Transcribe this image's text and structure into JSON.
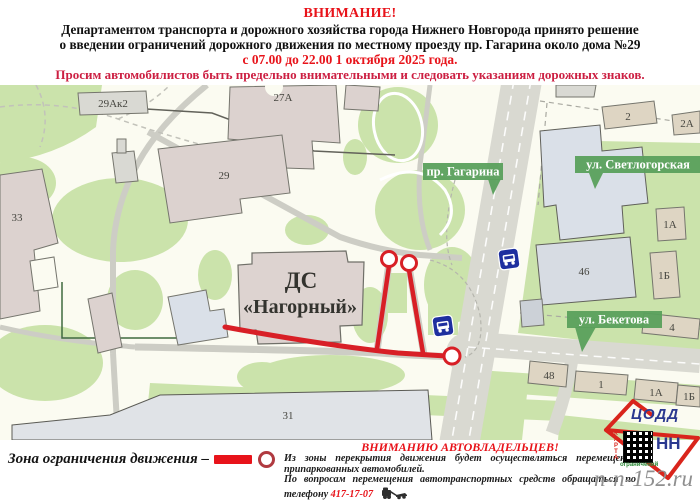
{
  "header": {
    "attention": "ВНИМАНИЕ!",
    "line1": "Департаментом транспорта и дорожного хозяйства города Нижнего Новгорода принято решение",
    "line2": "о введении ограничений дорожного движения по местному проезду пр. Гагарина около дома №29",
    "schedule": "с 07.00 до 22.00 1 октября 2025 года.",
    "plea": "Просим автомобилистов быть предельно внимательными и следовать указаниям дорожных знаков."
  },
  "map": {
    "streets": [
      {
        "name": "пр. Гагарина"
      },
      {
        "name": "ул. Светлогорская"
      },
      {
        "name": "ул. Бекетова"
      }
    ],
    "venue": {
      "line1": "ДС",
      "line2": "«Нагорный»"
    },
    "building_labels": [
      "29Ак2",
      "27А",
      "29",
      "33",
      "31",
      "2",
      "2А",
      "1А",
      "1Б",
      "46",
      "4",
      "48",
      "1",
      "1А",
      "1Б"
    ]
  },
  "legend": {
    "label": "Зона ограничения движения –"
  },
  "notice": {
    "title": "ВНИМАНИЮ АВТОВЛАДЕЛЬЦЕВ!",
    "body1": "Из зоны перекрытия движения будет осуществляться перемещение припаркованных автомобилей.",
    "body2": "По вопросам перемещения автотранспортных средств обращаться по телефону",
    "phone": "417-17-07"
  },
  "logo": {
    "org": "ЦОДД",
    "city": "НН",
    "karta": "КАРТА",
    "caption": "ограничений"
  },
  "watermark": "n-n-152.ru",
  "colors": {
    "accent_red": "#e8131a",
    "plea_crimson": "#cc1f42",
    "map_green": "#cbe3ab",
    "badge_green": "#5aa05c",
    "restriction_red": "#d81f26",
    "sign_blue": "#1e2f9f"
  }
}
